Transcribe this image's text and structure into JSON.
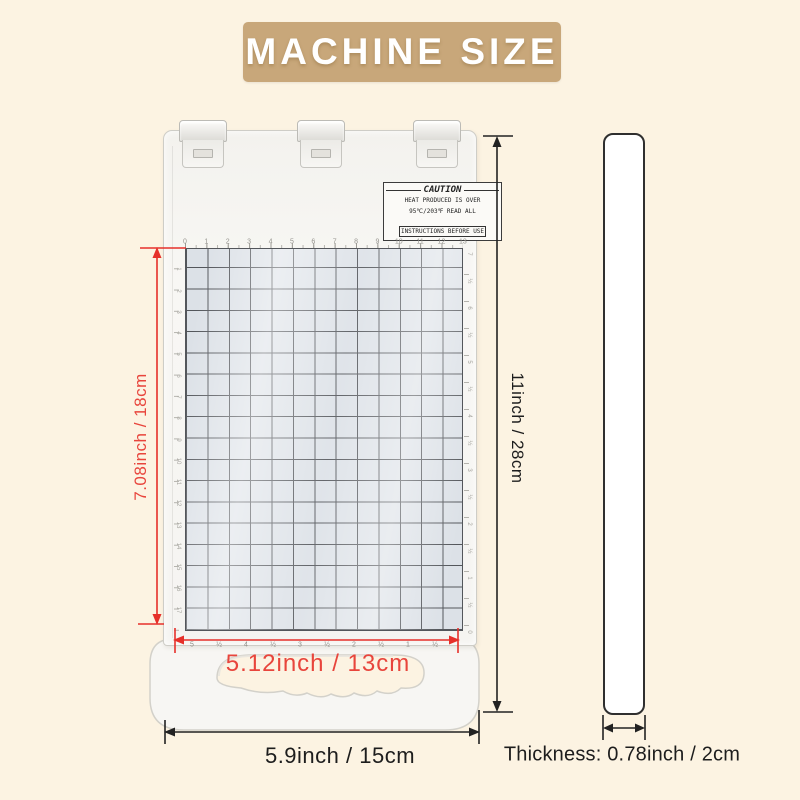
{
  "banner": {
    "label": "MACHINE SIZE",
    "bg": "#c8a77a"
  },
  "caution": {
    "title": "CAUTION",
    "line1": "HEAT PRODUCED IS OVER",
    "line2": "95℃/203℉ READ ALL",
    "line3": "INSTRUCTIONS BEFORE USE"
  },
  "annotations": {
    "grid_height": "7.08inch / 18cm",
    "grid_width": "5.12inch / 13cm",
    "machine_height": "11inch / 28cm",
    "machine_width": "5.9inch / 15cm",
    "thickness": "Thickness: 0.78inch / 2cm"
  },
  "rulers": {
    "top_cm": [
      "0",
      "1",
      "2",
      "3",
      "4",
      "5",
      "6",
      "7",
      "8",
      "9",
      "10",
      "11",
      "12",
      "13"
    ],
    "left_cm": [
      "1",
      "2",
      "3",
      "4",
      "5",
      "6",
      "7",
      "8",
      "9",
      "10",
      "11",
      "12",
      "13",
      "14",
      "15",
      "16",
      "17"
    ],
    "bottom_inch": [
      "5",
      "½",
      "4",
      "½",
      "3",
      "½",
      "2",
      "½",
      "1",
      "½"
    ],
    "right_inch": [
      "7",
      "½",
      "6",
      "½",
      "5",
      "½",
      "4",
      "½",
      "3",
      "½",
      "2",
      "½",
      "1",
      "½",
      "0"
    ]
  },
  "colors": {
    "background": "#fcf3e2",
    "banner": "#c8a77a",
    "red_dim": "#e6302a",
    "black_dim": "#222222",
    "grid_cell": "#dce1e7",
    "grid_line": "#53565b"
  }
}
